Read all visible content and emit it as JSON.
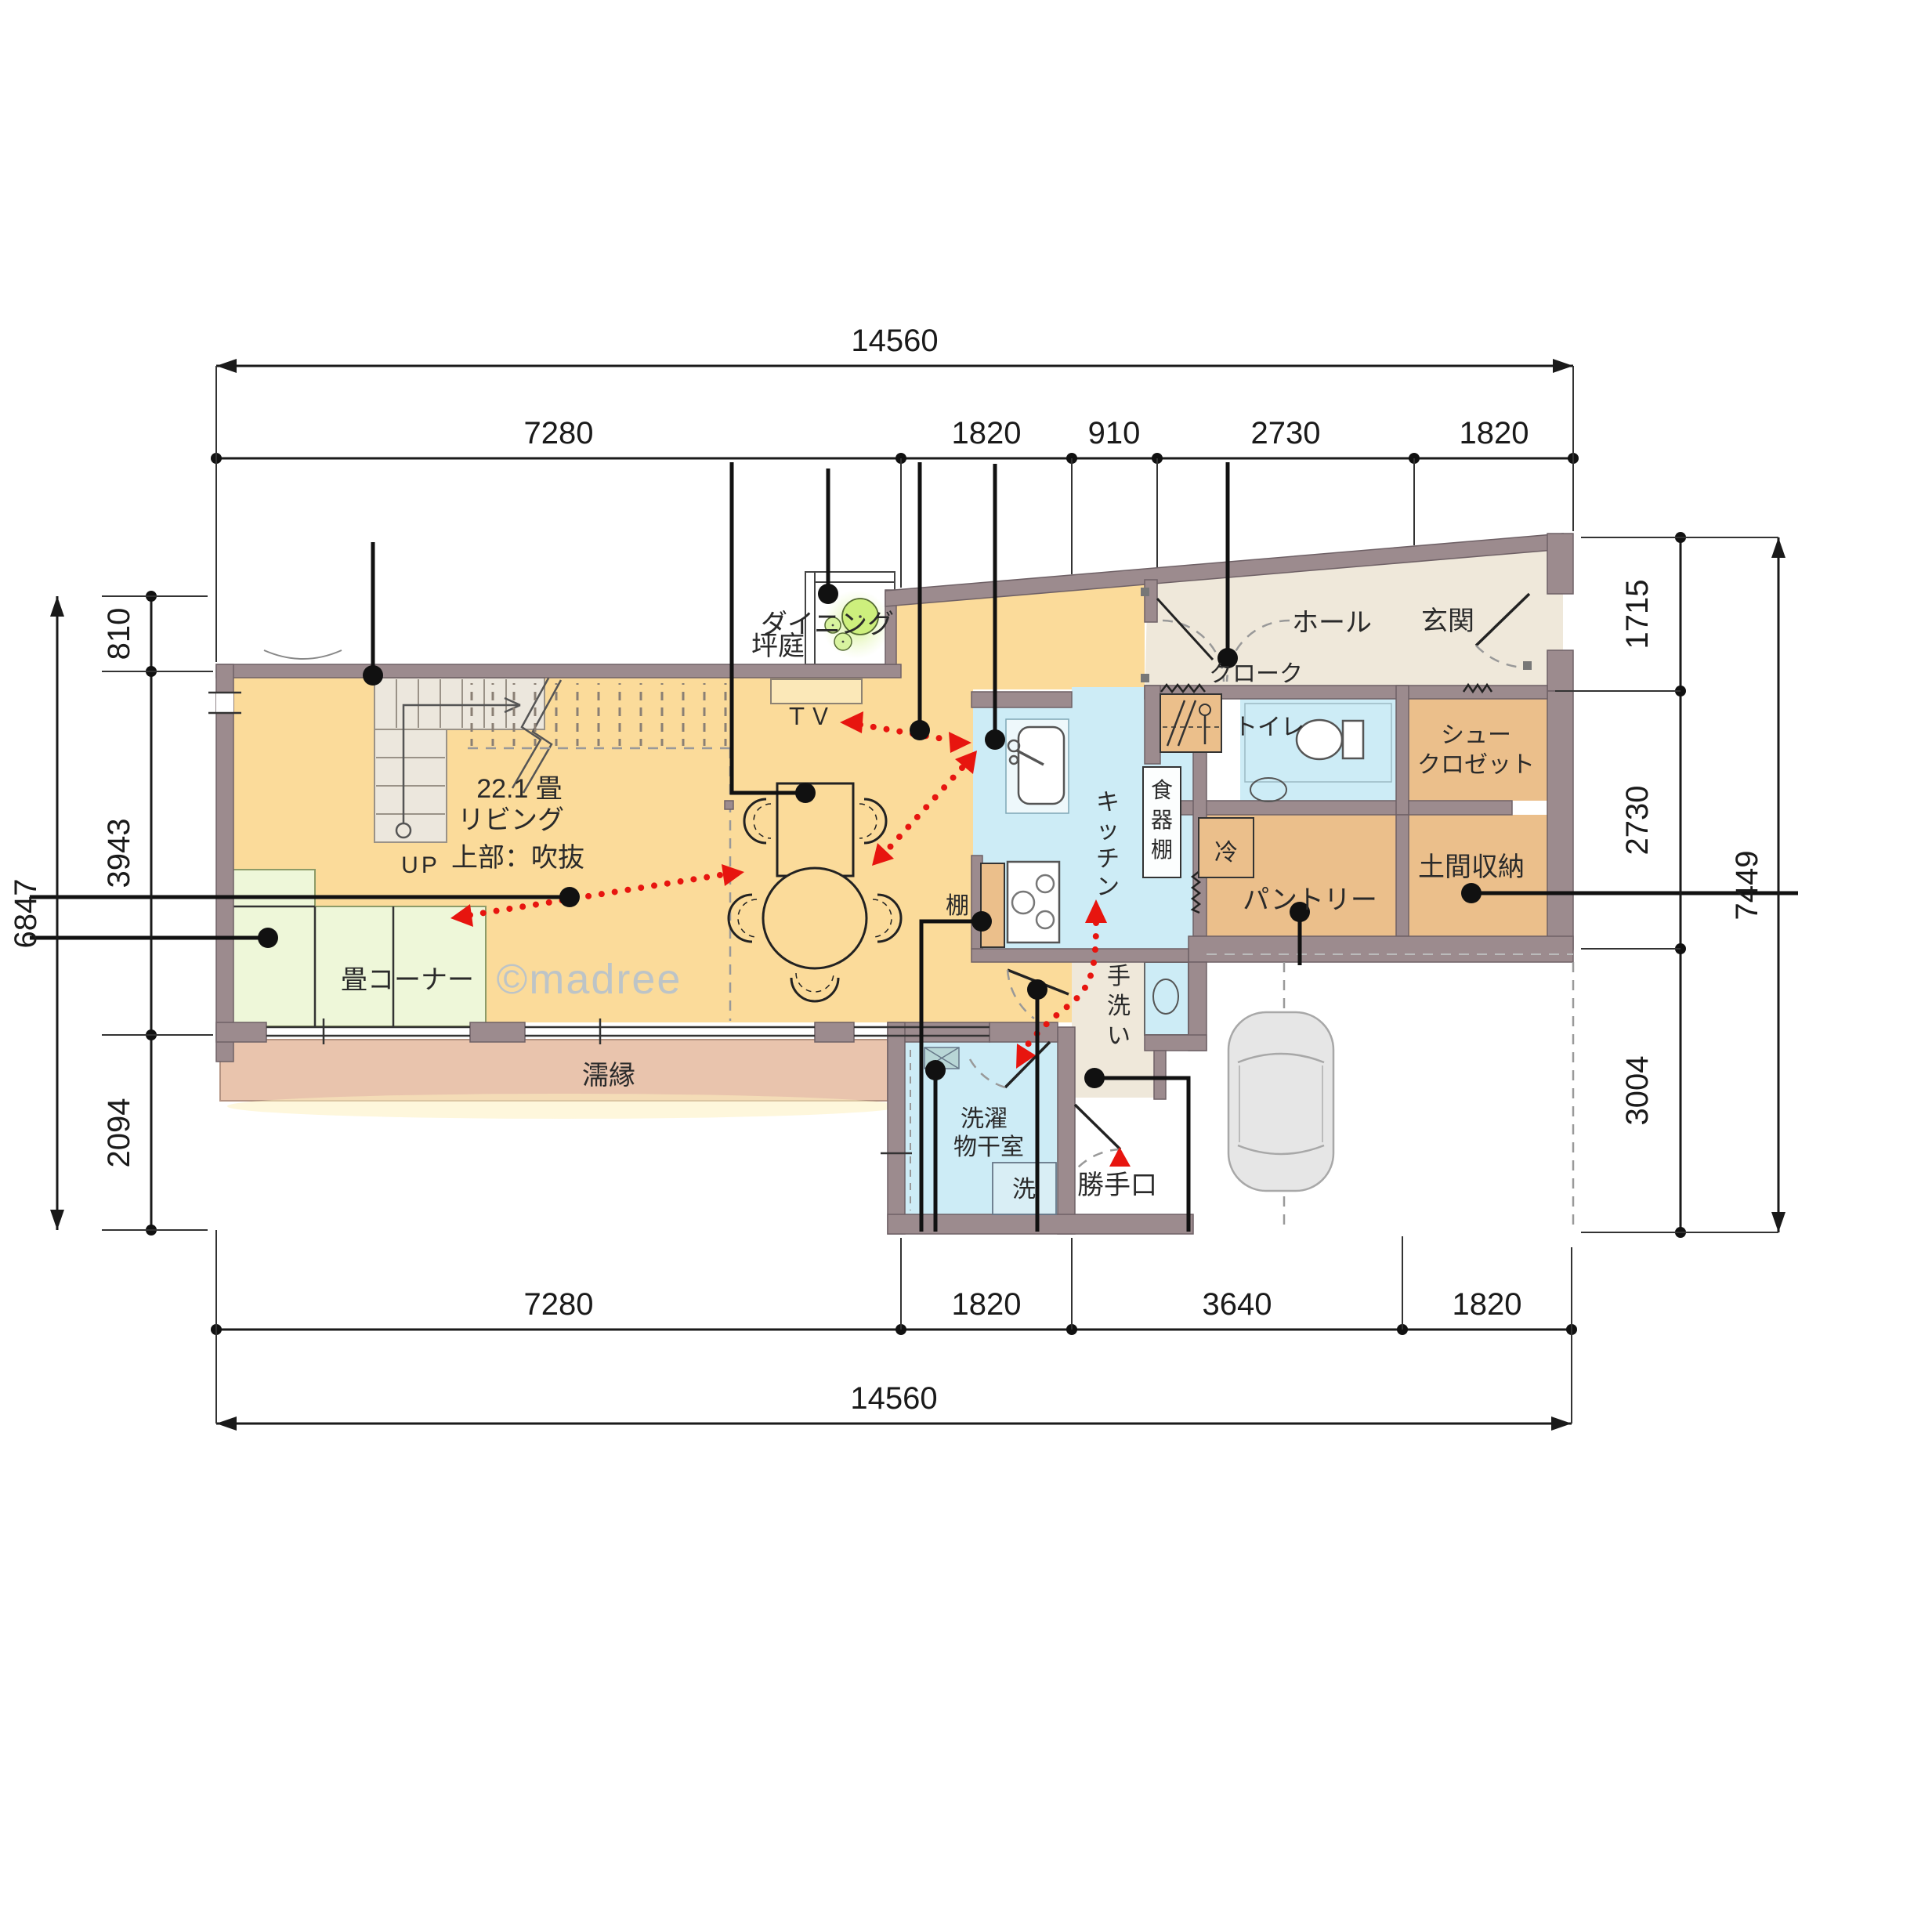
{
  "watermark": "©madree",
  "dimensions": {
    "top": {
      "total": "14560",
      "segments": [
        "7280",
        "1820",
        "910",
        "2730",
        "1820"
      ]
    },
    "bottom": {
      "total": "14560",
      "segments": [
        "7280",
        "1820",
        "3640",
        "1820"
      ]
    },
    "left": {
      "total": "6847",
      "segments": [
        "810",
        "3943",
        "2094"
      ]
    },
    "right": {
      "total": "7449",
      "segments": [
        "1715",
        "2730",
        "3004"
      ]
    }
  },
  "rooms": {
    "living": {
      "size": "22.1 畳",
      "name": "リビング",
      "note": "上部：吹抜"
    },
    "dining": "ダイニング",
    "kitchen": {
      "chars": [
        "キ",
        "ッ",
        "チ",
        "ン"
      ]
    },
    "dish_shelf": {
      "chars": [
        "食",
        "器",
        "棚"
      ]
    },
    "shelf": "棚",
    "pantry": "パントリー",
    "fridge": "冷",
    "doma": "土間収納",
    "shoe_closet": {
      "line1": "シュー",
      "line2": "クロゼット"
    },
    "toilet": "トイレ",
    "cloak": "クローク",
    "hall": "ホール",
    "entrance": "玄関",
    "courtyard": "坪庭",
    "tv": "ＴＶ",
    "stairs_up": "UP",
    "tatami": "畳コーナー",
    "veranda": "濡縁",
    "laundry": {
      "line1": "洗濯",
      "line2": "物干室"
    },
    "washer": "洗",
    "handwash": {
      "chars": [
        "手",
        "洗",
        "い"
      ]
    },
    "backdoor": "勝手口"
  },
  "colors": {
    "wall": "#9c8b8e",
    "floor_wood": "#fbdb9a",
    "floor_beige": "#efe8da",
    "floor_wet_blue": "#cdecf6",
    "floor_storage_tan": "#ebbf8b",
    "tatami_green": "#eef7d9",
    "veranda_salmon": "#e9c4ad",
    "plant_green": "#c7ed7d",
    "flow_arrow_red": "#e7150f",
    "watermark_blue": "#aebfd3"
  }
}
